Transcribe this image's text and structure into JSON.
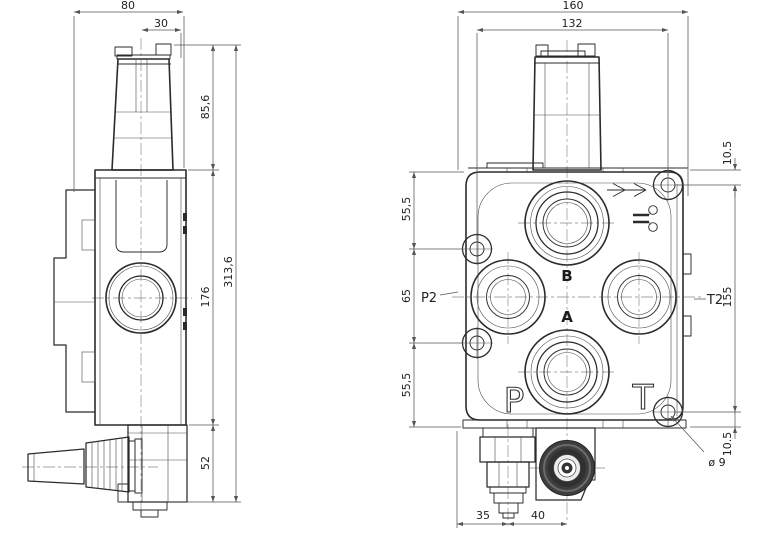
{
  "sheet": {
    "background": "#ffffff",
    "outline_color": "#2b2b2b",
    "dimension_color": "#555555",
    "knob_dark_color": "#3e3e3e"
  },
  "side_view": {
    "dims": {
      "total_width": "80",
      "spool_offset": "30",
      "cap_height": "85,6",
      "body_height": "176",
      "lower_height": "52",
      "total_height": "313,6"
    }
  },
  "front_view": {
    "dims": {
      "total_width": "160",
      "hole_span_width": "132",
      "top_edge_to_hole": "10.5",
      "hole_span_height": "155",
      "hole_to_bottom_edge": "10.5",
      "left_upper": "55,5",
      "left_middle": "65",
      "left_lower": "55,5",
      "bottom_left": "35",
      "bottom_right": "40",
      "mount_hole_diameter": "ø 9"
    },
    "port_labels": {
      "top": "B",
      "middle": "A",
      "bottom_left": "P",
      "bottom_right": "T",
      "left": "P2",
      "right": "T2"
    }
  }
}
